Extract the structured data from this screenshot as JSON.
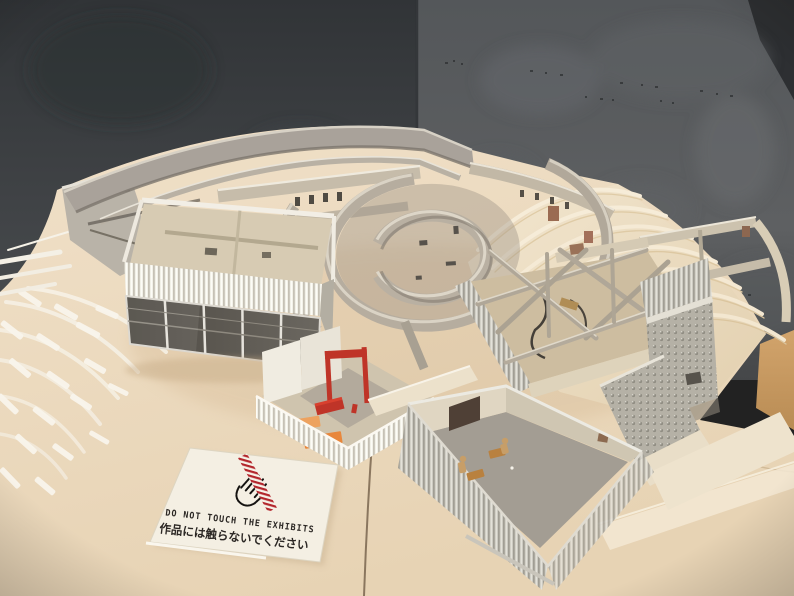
{
  "sign": {
    "icon": "no-touch-hand-icon",
    "text_en": "DO NOT TOUCH THE EXHIBITS",
    "text_ja": "作品には触らないでください"
  },
  "colors": {
    "accent_red": "#bf3428",
    "accent_red_bright": "#d8402e",
    "accent_orange": "#e8873c",
    "accent_orange_light": "#eda25f",
    "sign_card": "#f4efe3",
    "sign_text": "#2b2724",
    "wall_dark": "#3a3d40",
    "wall_light": "#5a5d5f",
    "base_cream": "#ecdabf",
    "model_gray": "#b2a99b",
    "terrace_white": "#f7f3e9",
    "wood_floor": "#c89c66"
  }
}
